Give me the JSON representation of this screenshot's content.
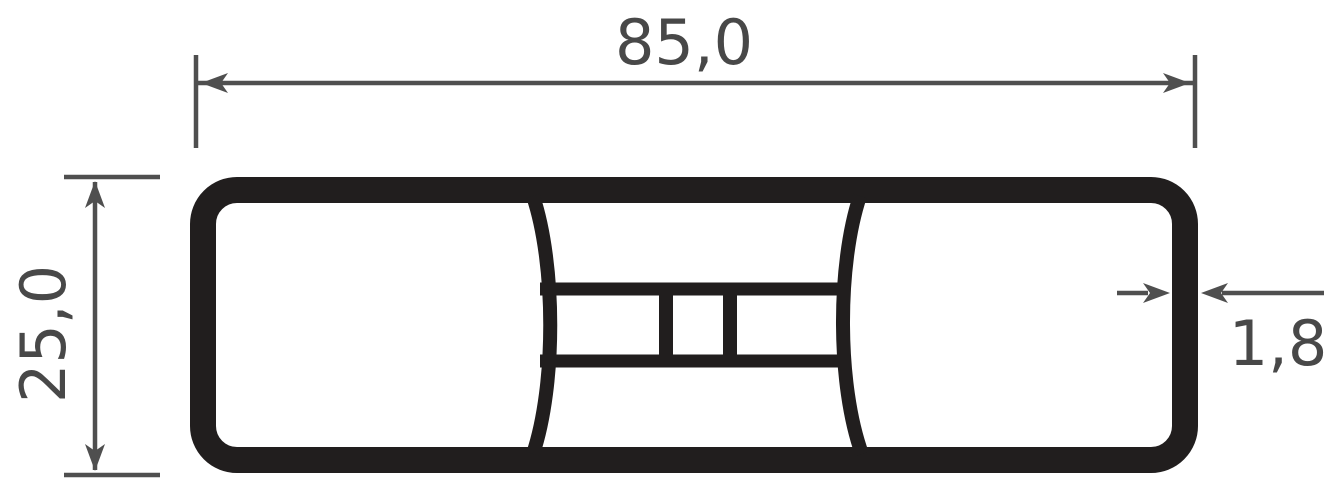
{
  "drawing": {
    "type": "profile-cross-section",
    "background": "#ffffff",
    "colors": {
      "profile_stroke": "#211e1e",
      "dimension_lines": "#4f4f4f",
      "dimension_text": "#484848"
    },
    "dimensions": {
      "width_label": "85,0",
      "height_label": "25,0",
      "wall_thickness_label": "1,8"
    }
  }
}
